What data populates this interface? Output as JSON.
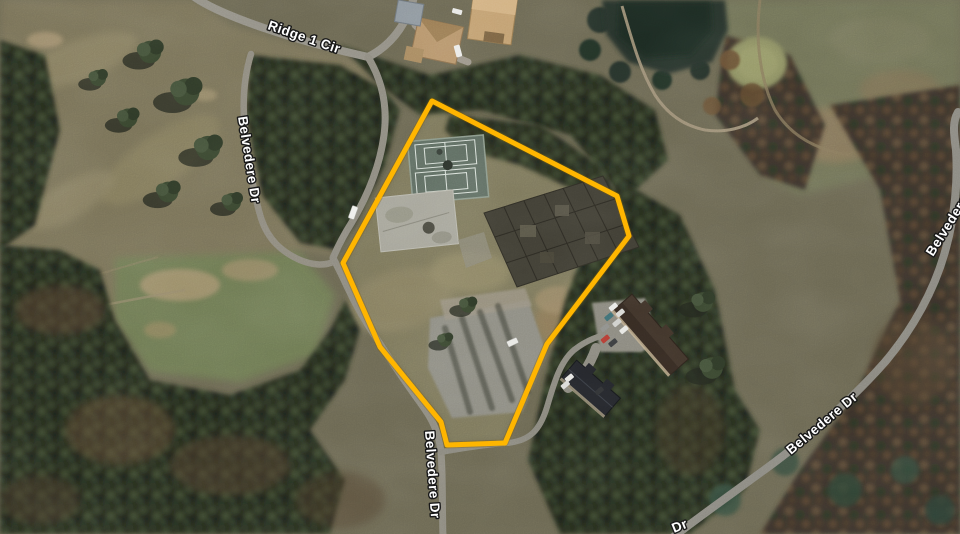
{
  "map": {
    "view": "aerial-satellite",
    "road_labels": [
      {
        "name": "ridge-1-cir",
        "text": "Ridge 1 Cir"
      },
      {
        "name": "belvedere-dr-west",
        "text": "Belvedere Dr"
      },
      {
        "name": "belvedere-dr-south",
        "text": "Belvedere Dr"
      },
      {
        "name": "belvedere-dr-southeast",
        "text": "Belvedere Dr"
      },
      {
        "name": "belvedere-dr-east-partial",
        "text": "Belvedere"
      },
      {
        "name": "belvedere-dr-bottom-partial",
        "text": "Dr"
      }
    ],
    "parcel": {
      "outline_color": "#FFB100",
      "outline_points": "432,101 617,196 629,236 547,344 505,443 447,445 441,422 380,347 343,263"
    }
  }
}
